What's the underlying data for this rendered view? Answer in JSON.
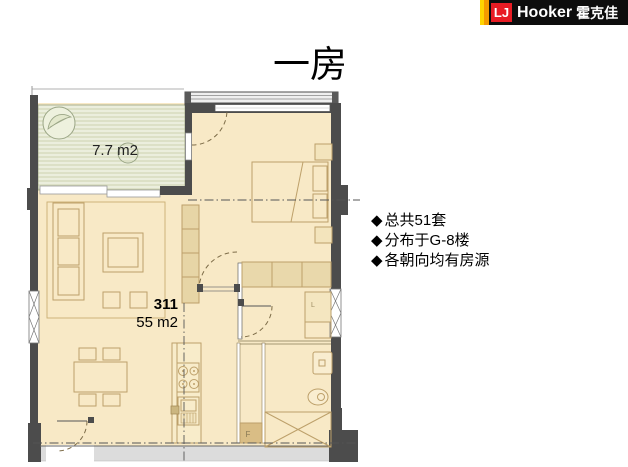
{
  "logo": {
    "initials": "LJ",
    "name": "Hooker",
    "cn": "霍克佳"
  },
  "title": "一房",
  "bullets": {
    "marker": "◆",
    "items": [
      {
        "text": "总共51套"
      },
      {
        "text": "分布于G-8楼"
      },
      {
        "text": "各朝向均有房源"
      }
    ]
  },
  "floorplan": {
    "balcony_area_label": "7.7 m2",
    "unit_number": "311",
    "unit_area_label": "55 m2",
    "fridge_label": "F",
    "closet_label": "L"
  },
  "colors": {
    "logo_red": "#e81c24",
    "logo_orange": "#f59b00",
    "logo_yellow": "#ffd400",
    "floor": "#f8e9c6",
    "balcony": "#ebeedd",
    "wall": "#4c4c4c",
    "furniture_line": "#bda06a",
    "corridor": "#dcdcdc"
  }
}
